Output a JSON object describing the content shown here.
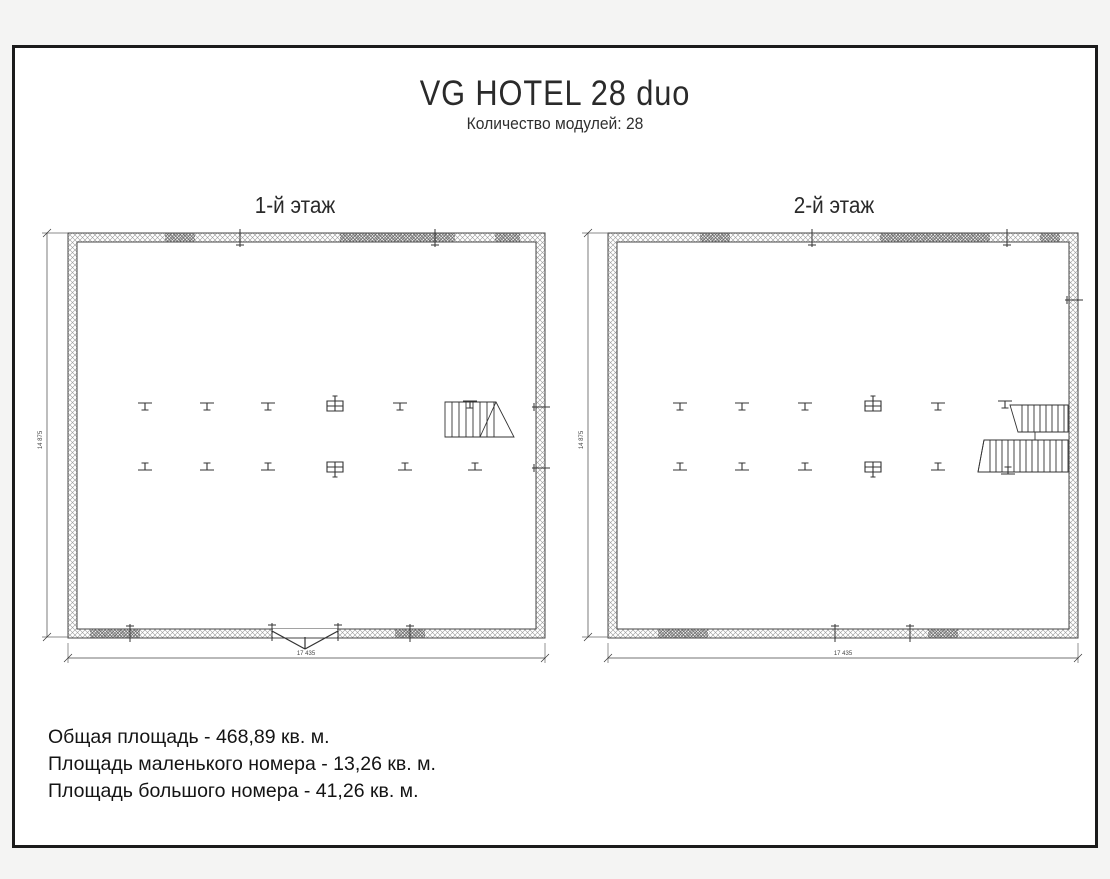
{
  "title": "VG HOTEL 28 duo",
  "subtitle": "Количество модулей: 28",
  "plans": [
    {
      "label": "1-й этаж",
      "width_dim": "17 435",
      "height_dim": "14 875"
    },
    {
      "label": "2-й этаж",
      "width_dim": "17 435",
      "height_dim": "14 875"
    }
  ],
  "notes": {
    "total_area": "Общая площадь - 468,89 кв. м.",
    "small_room_area": "Площадь маленького номера - 13,26 кв. м.",
    "large_room_area": "Площадь большого номера - 41,26 кв. м."
  },
  "colors": {
    "frame": "#1b1b1b",
    "wall_line": "#444444",
    "symbol_line": "#333333",
    "paper": "#ffffff",
    "background": "#f4f4f3",
    "text": "#141414"
  }
}
